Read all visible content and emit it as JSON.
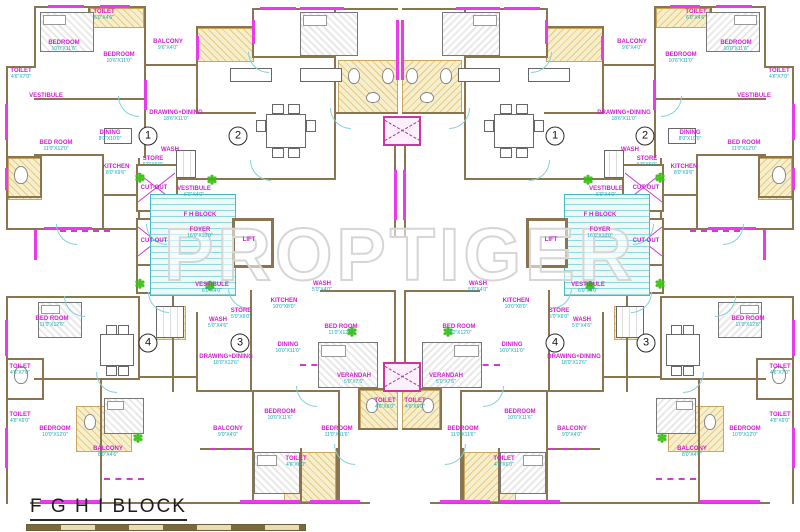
{
  "title": {
    "block_label": "F G H I BLOCK"
  },
  "watermark": "PROPTIGER",
  "colors": {
    "wall_brown": "#8a7550",
    "wall_magenta": "#e93be9",
    "label_magenta": "#cf1fcf",
    "dim_cyan": "#17a9b5",
    "stair_cyan": "#49b9c4",
    "hatch_yellow": "#f7efcc",
    "plant_green": "#3bc513",
    "watermark_gray": "#d6d6d6"
  },
  "unit_numbers": [
    {
      "n": "1",
      "x": 148,
      "y": 136
    },
    {
      "n": "2",
      "x": 238,
      "y": 136
    },
    {
      "n": "1",
      "x": 555,
      "y": 136
    },
    {
      "n": "2",
      "x": 645,
      "y": 136
    },
    {
      "n": "4",
      "x": 148,
      "y": 343
    },
    {
      "n": "3",
      "x": 240,
      "y": 343
    },
    {
      "n": "4",
      "x": 555,
      "y": 343
    },
    {
      "n": "3",
      "x": 646,
      "y": 343
    }
  ],
  "labels": [
    {
      "t": "TOILET",
      "d": "6'0\"X4'6\"",
      "x": 104,
      "y": 15,
      "m": 1
    },
    {
      "t": "BEDROOM",
      "d": "10'0\"X11'6\"",
      "x": 64,
      "y": 46,
      "m": 1
    },
    {
      "t": "BEDROOM",
      "d": "10'6\"X11'0\"",
      "x": 119,
      "y": 58,
      "m": 1
    },
    {
      "t": "BALCONY",
      "d": "9'6\"X4'0\"",
      "x": 168,
      "y": 45,
      "m": 1
    },
    {
      "t": "TOILET",
      "d": "4'6\"X7'0\"",
      "x": 21,
      "y": 74,
      "m": 1
    },
    {
      "t": "VESTIBULE",
      "d": "",
      "x": 46,
      "y": 96,
      "m": 1
    },
    {
      "t": "DINING",
      "d": "8'0\"X10'0\"",
      "x": 110,
      "y": 136,
      "m": 1
    },
    {
      "t": "BED ROOM",
      "d": "11'0\"X12'0\"",
      "x": 56,
      "y": 146,
      "m": 1
    },
    {
      "t": "KITCHEN",
      "d": "8'0\"X9'6\"",
      "x": 116,
      "y": 170,
      "m": 1
    },
    {
      "t": "DRAWING+DINING",
      "d": "18'6\"X11'0\"",
      "x": 176,
      "y": 116,
      "m": 1
    },
    {
      "t": "WASH",
      "d": "",
      "x": 170,
      "y": 150,
      "m": 1
    },
    {
      "t": "STORE",
      "d": "5'0\"X6'0\"",
      "x": 153,
      "y": 162,
      "m": 1
    },
    {
      "t": "CUT-OUT",
      "d": "",
      "x": 154,
      "y": 188,
      "m": 1
    },
    {
      "t": "VESTIBULE",
      "d": "6'0\"X4'0\"",
      "x": 194,
      "y": 192,
      "m": 1
    },
    {
      "t": "F H BLOCK",
      "d": "",
      "x": 200,
      "y": 215,
      "m": 1
    },
    {
      "t": "FOYER",
      "d": "16'0\"X10'0\"",
      "x": 200,
      "y": 233,
      "m": 1
    },
    {
      "t": "LIFT",
      "d": "",
      "x": 249,
      "y": 240,
      "m": 1
    },
    {
      "t": "CUT-OUT",
      "d": "",
      "x": 154,
      "y": 241,
      "m": 1
    },
    {
      "t": "VESTIBULE",
      "d": "6'0\"X4'0\"",
      "x": 212,
      "y": 288,
      "m": 1
    },
    {
      "t": "WASH",
      "d": "5'0\"X4'0\"",
      "x": 322,
      "y": 287,
      "m": 1
    },
    {
      "t": "KITCHEN",
      "d": "10'0\"X8'0\"",
      "x": 284,
      "y": 304,
      "m": 1
    },
    {
      "t": "STORE",
      "d": "5'0\"X6'0\"",
      "x": 241,
      "y": 314,
      "m": 1
    },
    {
      "t": "WASH",
      "d": "5'0\"X4'6\"",
      "x": 218,
      "y": 323,
      "m": 1
    },
    {
      "t": "DINING",
      "d": "10'0\"X11'0\"",
      "x": 288,
      "y": 348,
      "m": 1
    },
    {
      "t": "DRAWING+DINING",
      "d": "18'0\"X12'6\"",
      "x": 226,
      "y": 360,
      "m": 1
    },
    {
      "t": "BED ROOM",
      "d": "11'0\"X12'0\"",
      "x": 341,
      "y": 330,
      "m": 1
    },
    {
      "t": "VERANDAH",
      "d": "5'0\"X7'6\"",
      "x": 354,
      "y": 379,
      "m": 1
    },
    {
      "t": "TOILET",
      "d": "4'6\"X6'0\"",
      "x": 385,
      "y": 404,
      "m": 1
    },
    {
      "t": "BEDROOM",
      "d": "10'0\"X11'6\"",
      "x": 280,
      "y": 415,
      "m": 1
    },
    {
      "t": "BALCONY",
      "d": "9'0\"X4'0\"",
      "x": 228,
      "y": 432,
      "m": 1
    },
    {
      "t": "TOILET",
      "d": "4'6\"X6'0\"",
      "x": 296,
      "y": 462,
      "m": 1
    },
    {
      "t": "BEDROOM",
      "d": "11'0\"X11'6\"",
      "x": 337,
      "y": 432,
      "m": 1
    },
    {
      "t": "BED ROOM",
      "d": "11'0\"X12'6\"",
      "x": 52,
      "y": 322,
      "m": 1
    },
    {
      "t": "TOILET",
      "d": "4'6\"X7'0\"",
      "x": 20,
      "y": 370,
      "m": 1
    },
    {
      "t": "BEDROOM",
      "d": "10'0\"X12'0\"",
      "x": 55,
      "y": 432,
      "m": 1
    },
    {
      "t": "BALCONY",
      "d": "8'0\"X4'6\"",
      "x": 108,
      "y": 452,
      "m": 1
    },
    {
      "t": "TOILET",
      "d": "4'6\"X6'0\"",
      "x": 20,
      "y": 418,
      "m": 1
    }
  ]
}
